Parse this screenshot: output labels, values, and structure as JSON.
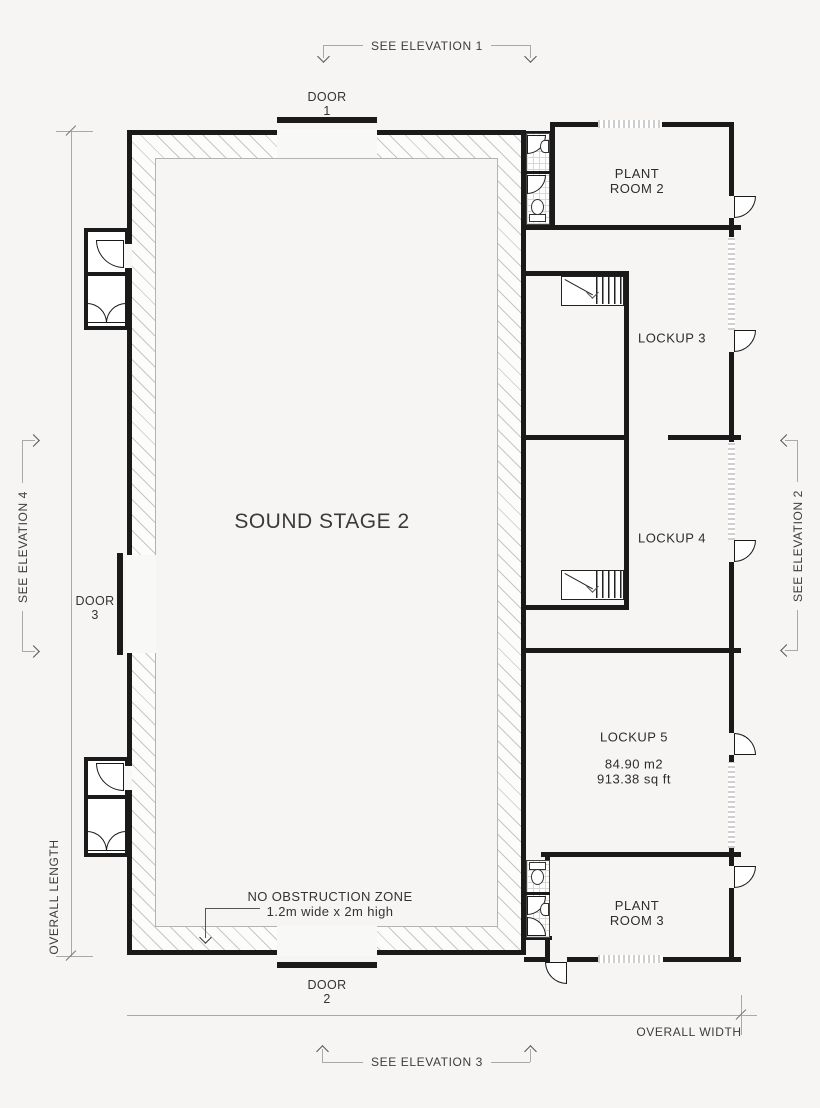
{
  "drawing": {
    "main_room": {
      "label": "SOUND STAGE 2"
    },
    "rooms": {
      "plant_room_2": {
        "line1": "PLANT",
        "line2": "ROOM 2"
      },
      "lockup_3": {
        "label": "LOCKUP 3"
      },
      "lockup_4": {
        "label": "LOCKUP 4"
      },
      "lockup_5": {
        "label": "LOCKUP 5",
        "area_m2": "84.90 m2",
        "area_sqft": "913.38 sq ft"
      },
      "plant_room_3": {
        "line1": "PLANT",
        "line2": "ROOM 3"
      }
    },
    "doors": {
      "door_1": {
        "label": "DOOR",
        "number": "1"
      },
      "door_2": {
        "label": "DOOR",
        "number": "2"
      },
      "door_3": {
        "label": "DOOR",
        "number": "3"
      }
    },
    "elevation_markers": {
      "elevation_1": "SEE ELEVATION 1",
      "elevation_2": "SEE ELEVATION 2",
      "elevation_3": "SEE ELEVATION 3",
      "elevation_4": "SEE ELEVATION 4"
    },
    "dimensions": {
      "overall_length": "OVERALL LENGTH",
      "overall_width": "OVERALL WIDTH"
    },
    "annotations": {
      "no_obstruction_line1": "NO OBSTRUCTION ZONE",
      "no_obstruction_line2": "1.2m wide x 2m high"
    },
    "colors": {
      "wall": "#1a1a1a",
      "background": "#f6f5f3",
      "hatch_line": "#c6c6c6",
      "dimension_line": "#a9a9a9",
      "text": "#333333"
    }
  }
}
